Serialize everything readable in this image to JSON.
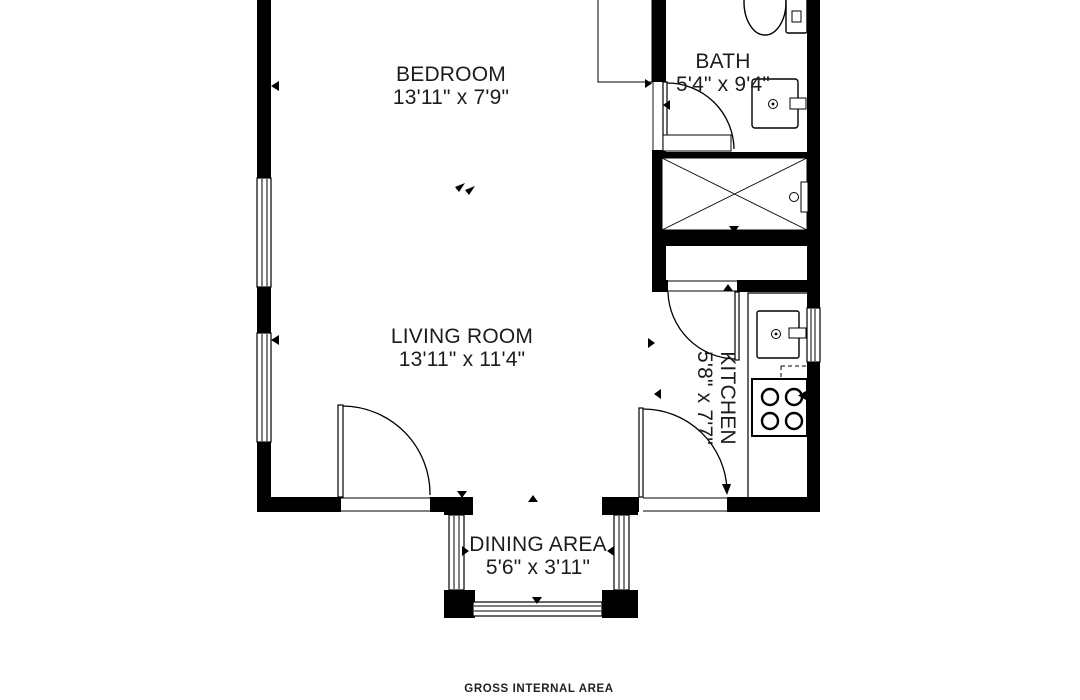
{
  "title": "Apartment floor plan",
  "colors": {
    "wall": "#000000",
    "background": "#ffffff",
    "text": "#1c1c1c"
  },
  "rooms": [
    {
      "id": "bedroom",
      "name": "BEDROOM",
      "dimensions": "13'11\" x 7'9\""
    },
    {
      "id": "bath",
      "name": "BATH",
      "dimensions": "5'4\" x 9'4\""
    },
    {
      "id": "living-room",
      "name": "LIVING ROOM",
      "dimensions": "13'11\" x 11'4\""
    },
    {
      "id": "kitchen",
      "name": "KITCHEN",
      "dimensions": "5'8\" x 7'7\""
    },
    {
      "id": "dining-area",
      "name": "DINING AREA",
      "dimensions": "5'6\" x 3'11\""
    }
  ],
  "fixtures": [
    "toilet",
    "bathroom-sink",
    "shower",
    "shower-screen",
    "wardrobe",
    "kitchen-counter",
    "kitchen-sink",
    "stove",
    "under-counter-appliance"
  ],
  "footer": {
    "label": "GROSS INTERNAL AREA"
  }
}
